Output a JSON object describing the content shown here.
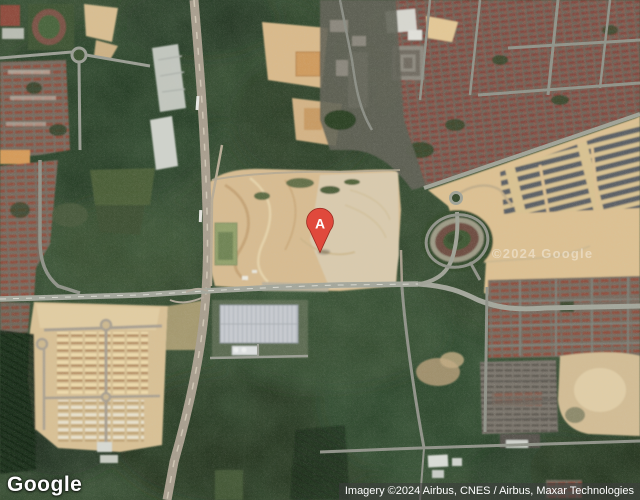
{
  "map": {
    "view_type": "satellite",
    "logo_text": "Google",
    "marker_label": "A",
    "attribution_text": "Imagery ©2024 Airbus, CNES / Airbus, Maxar Technologies",
    "watermark_text": "©2024 Google",
    "colors": {
      "marker_fill": "#E0493C",
      "marker_stroke": "#99291F",
      "marker_label_color": "#FFFFFF",
      "logo_text": "#FFFFFF",
      "attribution_bg": "rgba(60,60,60,0.58)",
      "attribution_text": "#FFFFFF",
      "forest_base": "#2b3e26",
      "sand": "#d8bd90"
    }
  }
}
